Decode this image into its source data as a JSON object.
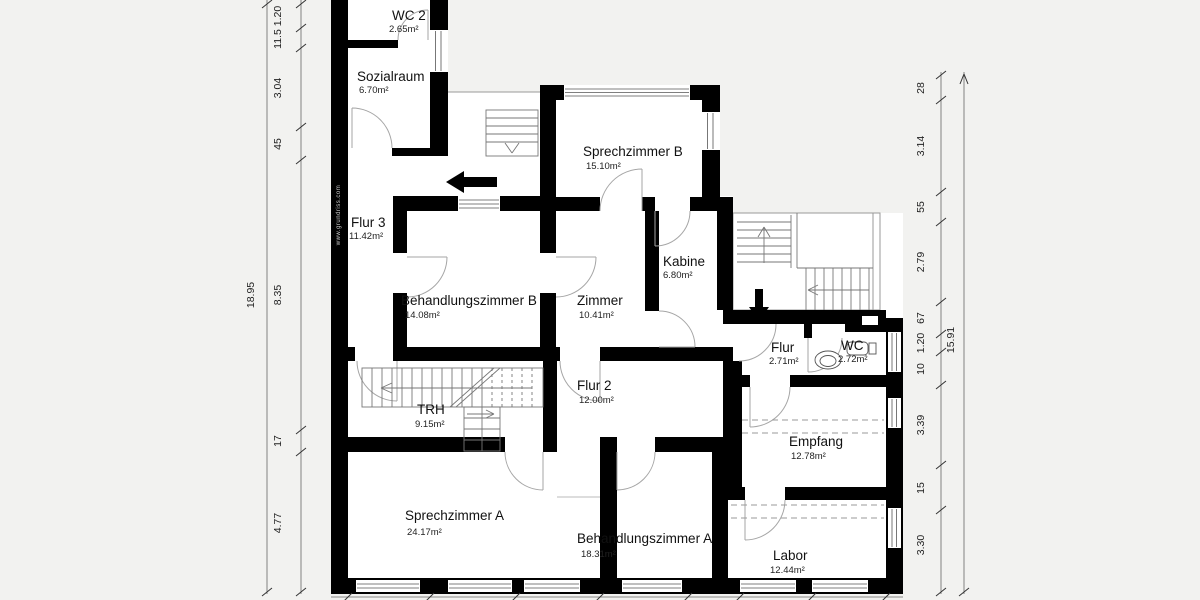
{
  "background": "#f2f2f0",
  "watermark": "www.grundriss.com",
  "rooms": [
    {
      "name": "WC 2",
      "area": "2.65m²"
    },
    {
      "name": "Sozialraum",
      "area": "6.70m²"
    },
    {
      "name": "Sprechzimmer B",
      "area": "15.10m²"
    },
    {
      "name": "Flur 3",
      "area": "11.42m²"
    },
    {
      "name": "Kabine",
      "area": "6.80m²"
    },
    {
      "name": "Behandlungszimmer B",
      "area": "14.08m²"
    },
    {
      "name": "Zimmer",
      "area": "10.41m²"
    },
    {
      "name": "Flur",
      "area": "2.71m²"
    },
    {
      "name": "WC",
      "area": "2.72m²"
    },
    {
      "name": "Flur 2",
      "area": "12.00m²"
    },
    {
      "name": "TRH",
      "area": "9.15m²"
    },
    {
      "name": "Empfang",
      "area": "12.78m²"
    },
    {
      "name": "Sprechzimmer A",
      "area": "24.17m²"
    },
    {
      "name": "Behandlungszimmer A",
      "area": "18.31m²"
    },
    {
      "name": "Labor",
      "area": "12.44m²"
    }
  ],
  "dims": {
    "left": {
      "overall": "18.95",
      "segments": [
        "1.20",
        "11.5",
        "3.04",
        "45",
        "8.35",
        "17",
        "4.77"
      ]
    },
    "right": {
      "overall": "15.91",
      "segments": [
        "28",
        "3.14",
        "55",
        "2.79",
        "67",
        "1.20",
        "10",
        "3.39",
        "15",
        "3.30"
      ]
    }
  }
}
